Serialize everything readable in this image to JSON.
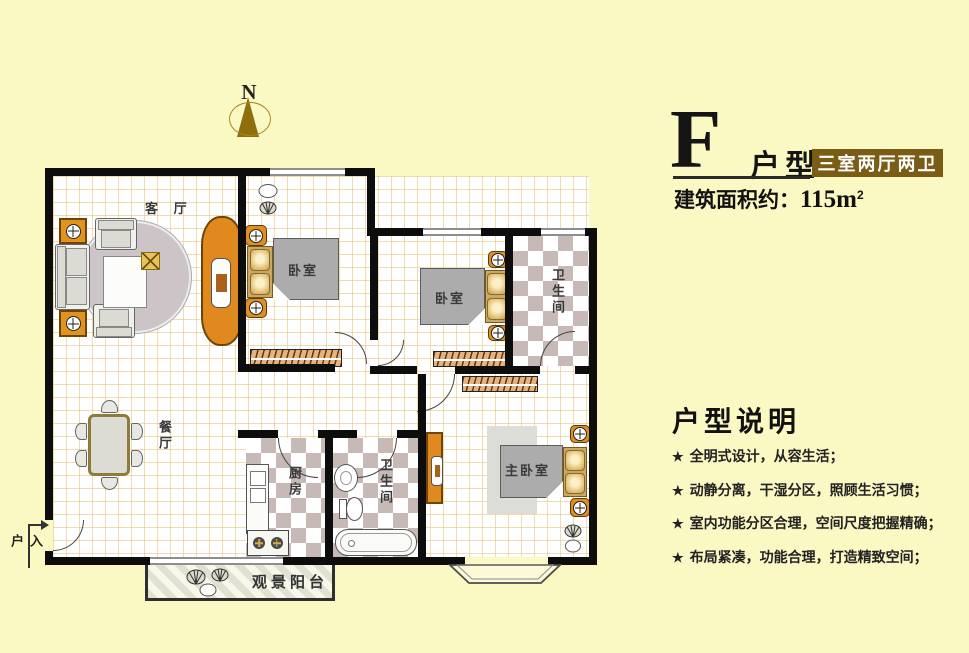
{
  "header": {
    "type_letter": "F",
    "type_name": "户型",
    "badge": "三室两厅两卫",
    "area_label": "建筑面积约：",
    "area_value": "115m",
    "area_exp": "2"
  },
  "north": {
    "label": "N"
  },
  "description": {
    "title": "户型说明",
    "star": "★",
    "items": [
      "全明式设计，从容生活；",
      "动静分离，干湿分区，照顾生活习惯；",
      "室内功能分区合理，空间尺度把握精确；",
      "布局紧凑，功能合理，打造精致空间；"
    ]
  },
  "floorplan": {
    "living": "客 厅",
    "bedroom1": "卧室",
    "bedroom2": "卧室",
    "bath1": "卫生间",
    "dining": "餐厅",
    "kitchen": "厨房",
    "bath2": "卫生间",
    "master": "主卧室",
    "balcony": "观景阳台",
    "entrance": "入户"
  },
  "colors": {
    "background": "#FAF8C3",
    "wall": "#0D0D0D",
    "badge_bg": "#7A5C14",
    "furniture_orange": "#E0891E",
    "cushion_gold": "#D9B36A",
    "checker_tile": "#C7BAB6",
    "grid_line": "#E2C480",
    "north_gold": "#8F6E0E"
  }
}
